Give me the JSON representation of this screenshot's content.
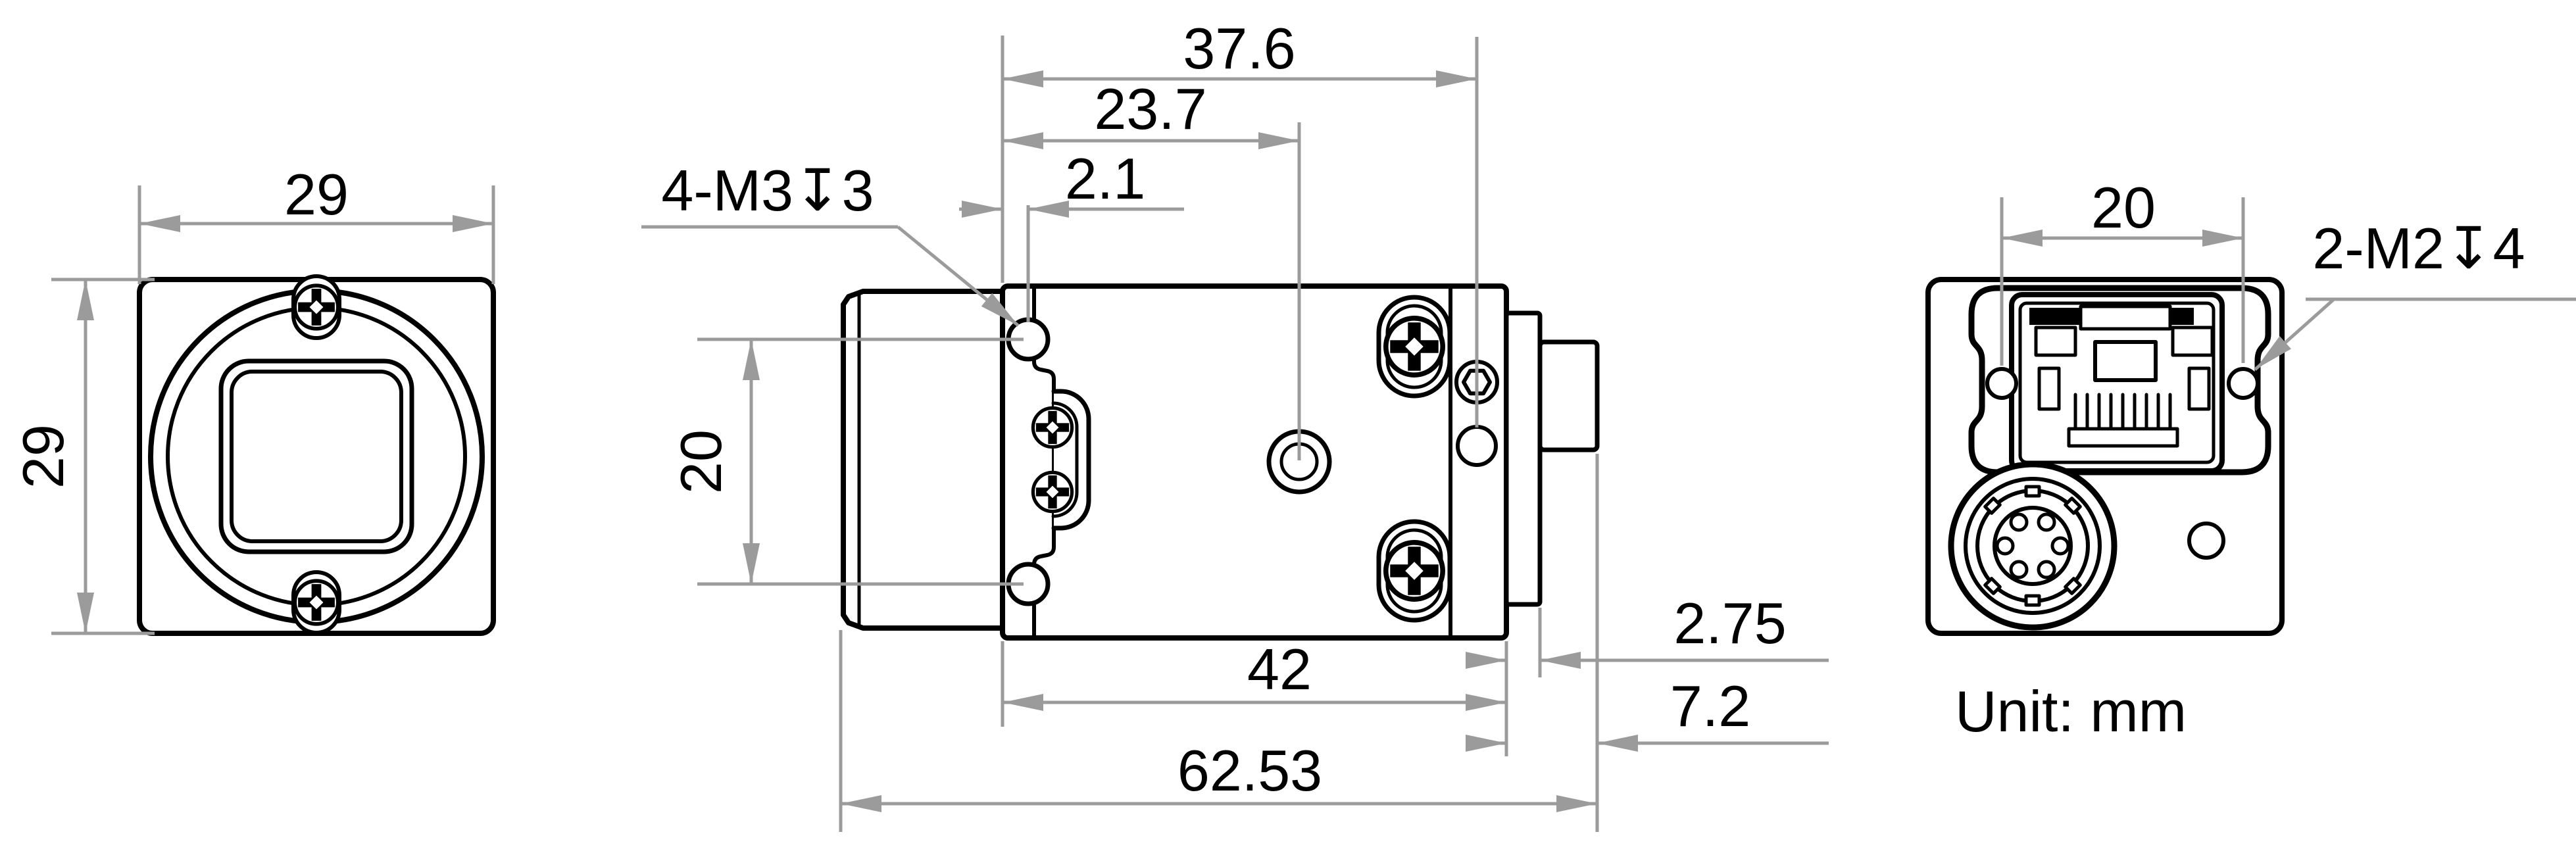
{
  "drawing": {
    "type": "technical-drawing",
    "unit_note": "Unit: mm",
    "line_color": "#000000",
    "dim_color": "#9b9b9b",
    "background": "#ffffff",
    "front_view": {
      "width": "29",
      "height": "29"
    },
    "side_view": {
      "front_to_rear_hole": "37.6",
      "front_to_tripod_hole": "23.7",
      "front_to_side_hole": "2.1",
      "side_hole_spacing": "20",
      "body_length": "42",
      "rear_step": "2.75",
      "rear_overhang": "7.2",
      "total_length": "62.53",
      "thread_label": "4-M3↧3"
    },
    "back_view": {
      "hole_spacing": "20",
      "thread_label": "2-M2↧4"
    }
  }
}
